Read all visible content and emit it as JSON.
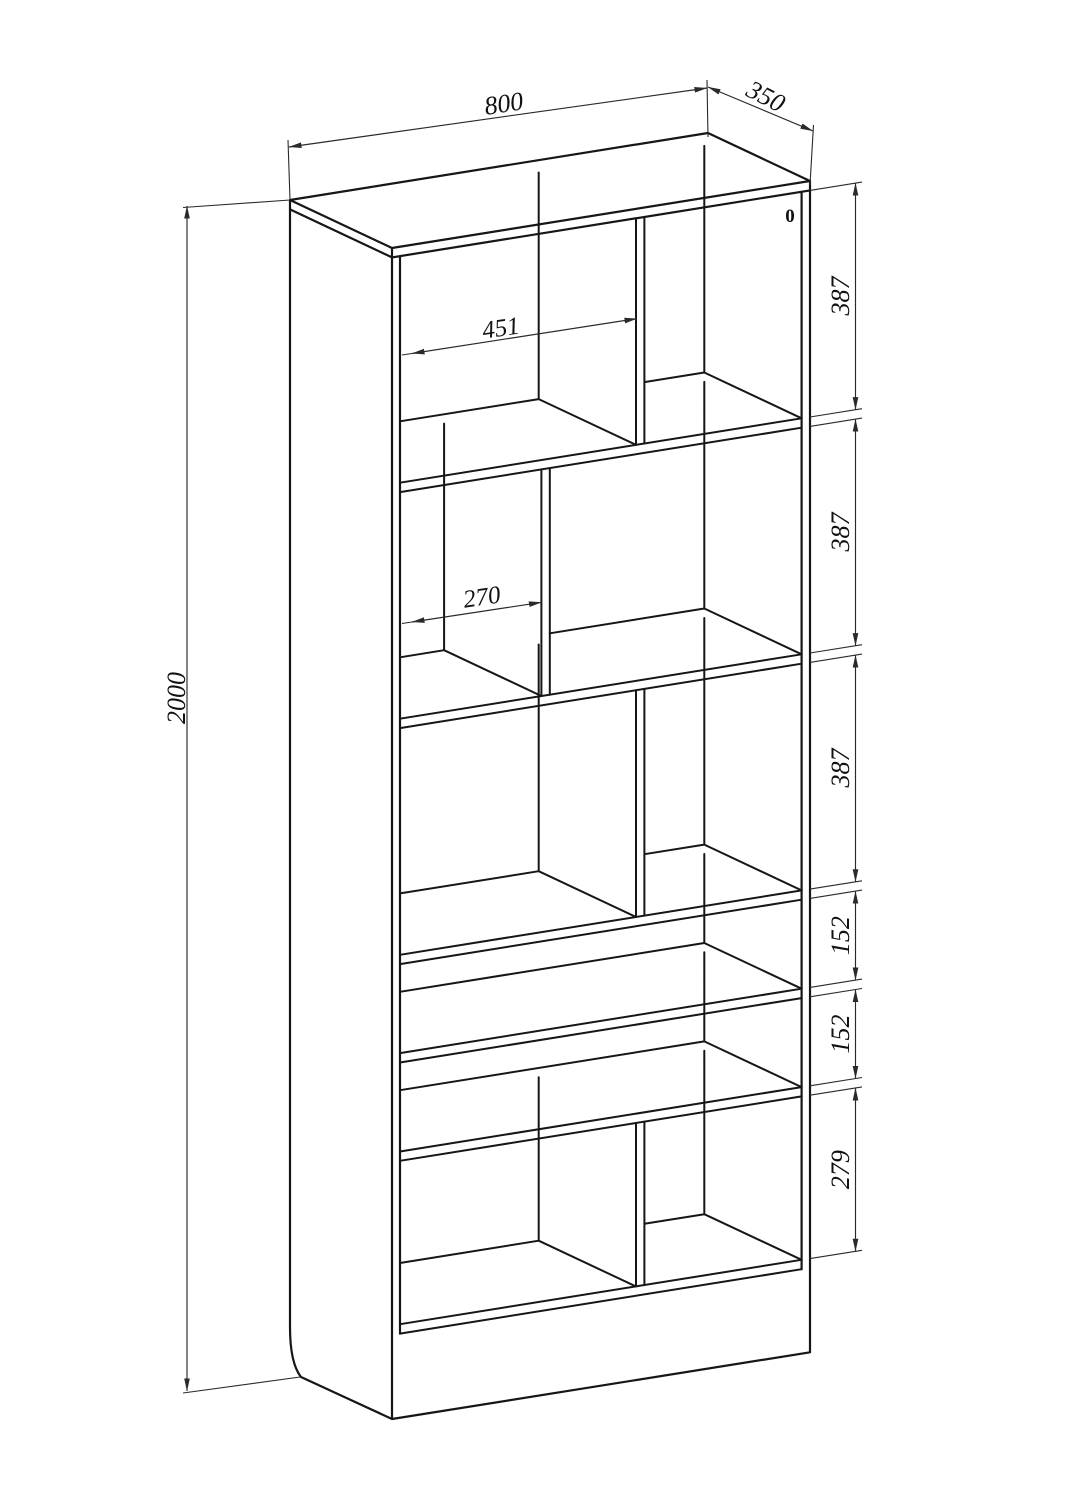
{
  "page": {
    "background": "#ffffff",
    "line_color": "#161616",
    "kind": "isometric dimensioned technical drawing of a tall open bookshelf"
  },
  "drawing": {
    "object": "bookshelf with 6 shelf rows and vertical dividers",
    "labels": {
      "width": "800",
      "depth": "350",
      "height": "2000",
      "row_heights": [
        "387",
        "387",
        "387",
        "152",
        "152",
        "279"
      ],
      "compartment_width_row1": "451",
      "compartment_width_row2": "270",
      "corner_marker": "0"
    },
    "units": "mm (implied, not printed)"
  }
}
